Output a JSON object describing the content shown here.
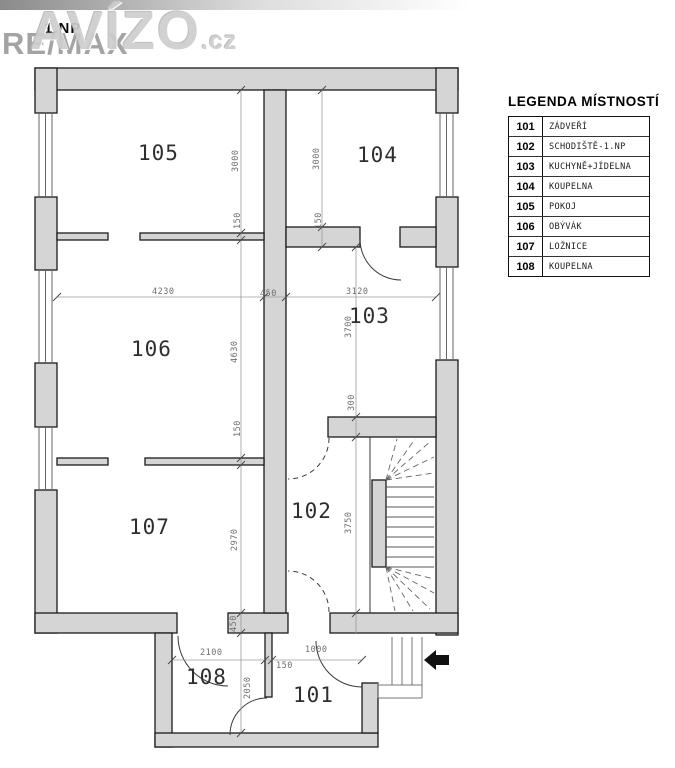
{
  "page": {
    "floor_label": "1.NP"
  },
  "watermark": {
    "brand": "RE/MAX",
    "site": "AVÍZO",
    "site_suffix": ".cz"
  },
  "legend": {
    "title": "LEGENDA MÍSTNOSTÍ",
    "rows": [
      {
        "num": "101",
        "name": "ZÁDVEŘÍ"
      },
      {
        "num": "102",
        "name": "SCHODIŠTĚ-1.NP"
      },
      {
        "num": "103",
        "name": "KUCHYNĚ+JÍDELNA"
      },
      {
        "num": "104",
        "name": "KOUPELNA"
      },
      {
        "num": "105",
        "name": "POKOJ"
      },
      {
        "num": "106",
        "name": "OBÝVÁK"
      },
      {
        "num": "107",
        "name": "LOŽNICE"
      },
      {
        "num": "108",
        "name": "KOUPELNA"
      }
    ]
  },
  "rooms": {
    "r101": "101",
    "r102": "102",
    "r103": "103",
    "r104": "104",
    "r105": "105",
    "r106": "106",
    "r107": "107",
    "r108": "108"
  },
  "dims": {
    "v3000_left": "3000",
    "v150_left_top": "150",
    "v4630": "4630",
    "v150_left_mid": "150",
    "v2970": "2970",
    "v450_left": "450",
    "v2050": "2050",
    "v3000_right": "3000",
    "v150_right": "150",
    "v3700": "3700",
    "v300": "300",
    "v3750": "3750",
    "h4230": "4230",
    "h450_mid": "450",
    "h3120": "3120",
    "h2100": "2100",
    "h150_bottom": "150",
    "h1000": "1000"
  },
  "colors": {
    "wall_fill": "#d5d5d5",
    "outline": "#1b1b1b",
    "dim_line": "#999999",
    "arrow": "#111111"
  }
}
